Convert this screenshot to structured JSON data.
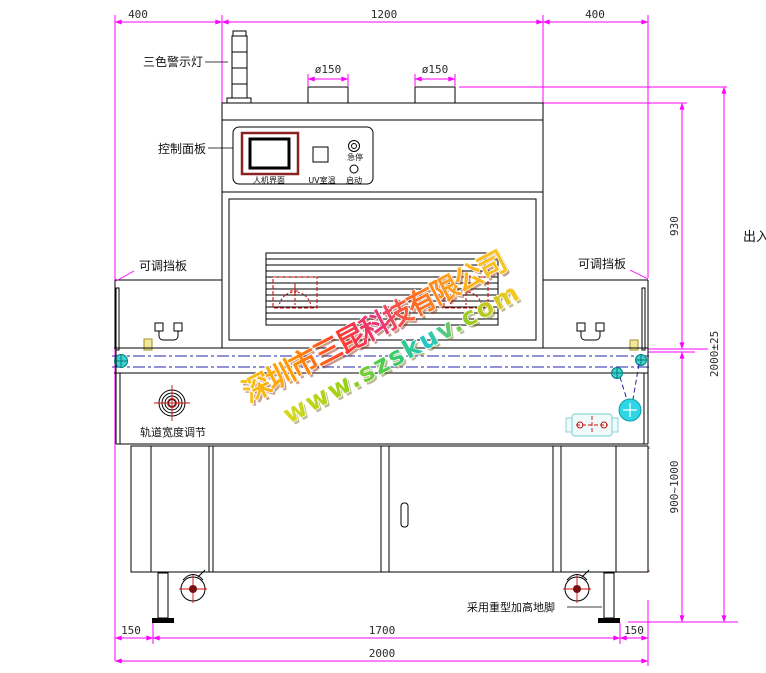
{
  "labels": {
    "warning_light": "三色警示灯",
    "control_panel": "控制面板",
    "baffle_left": "可调挡板",
    "baffle_right": "可调挡板",
    "track_width": "轨道宽度调节",
    "feet": "采用重型加高地脚",
    "outlet": "出入"
  },
  "panel": {
    "hmi": "人机界面",
    "uv_temp": "UV室温",
    "estop": "急停",
    "start": "启动"
  },
  "dims": {
    "top_left": "400",
    "top_center": "1200",
    "top_right": "400",
    "port_left": "ø150",
    "port_right": "ø150",
    "hood_height": "930",
    "overall_height": "2000±25",
    "stand_height": "900~1000",
    "cabinet_height": "480",
    "bottom_left": "150",
    "bottom_center": "1700",
    "bottom_right": "150",
    "overall_width": "2000"
  },
  "watermark": {
    "company": "深圳市三昆科技有限公司",
    "website": "www.szskuv.com"
  },
  "colors": {
    "dimension": "#ff00ff",
    "outline": "#000000",
    "light_red": "#ff1111",
    "light_yellow": "#ffee00",
    "light_green": "#00cc22",
    "light_base": "#c9c9c9",
    "light_cap": "#eeeeee",
    "screen_frame": "#8b2323",
    "lamp": "#cc1111",
    "belt_line": "#2323a8",
    "roller": "#3ecfcf",
    "pulley": "#2fd6e6",
    "motor": "#9fdcdc",
    "product": "#f2e6a0",
    "wheel_hub": "#7a1010",
    "wm_company_palette": [
      "#f7c51e",
      "#ff9a00",
      "#ff3a2e",
      "#e8357f",
      "#ff6a22",
      "#ffb31a"
    ],
    "wm_site_palette": [
      "#d8d820",
      "#9ed016",
      "#3ecb5a",
      "#1fc8c8",
      "#9acc22",
      "#ffc81e"
    ]
  }
}
